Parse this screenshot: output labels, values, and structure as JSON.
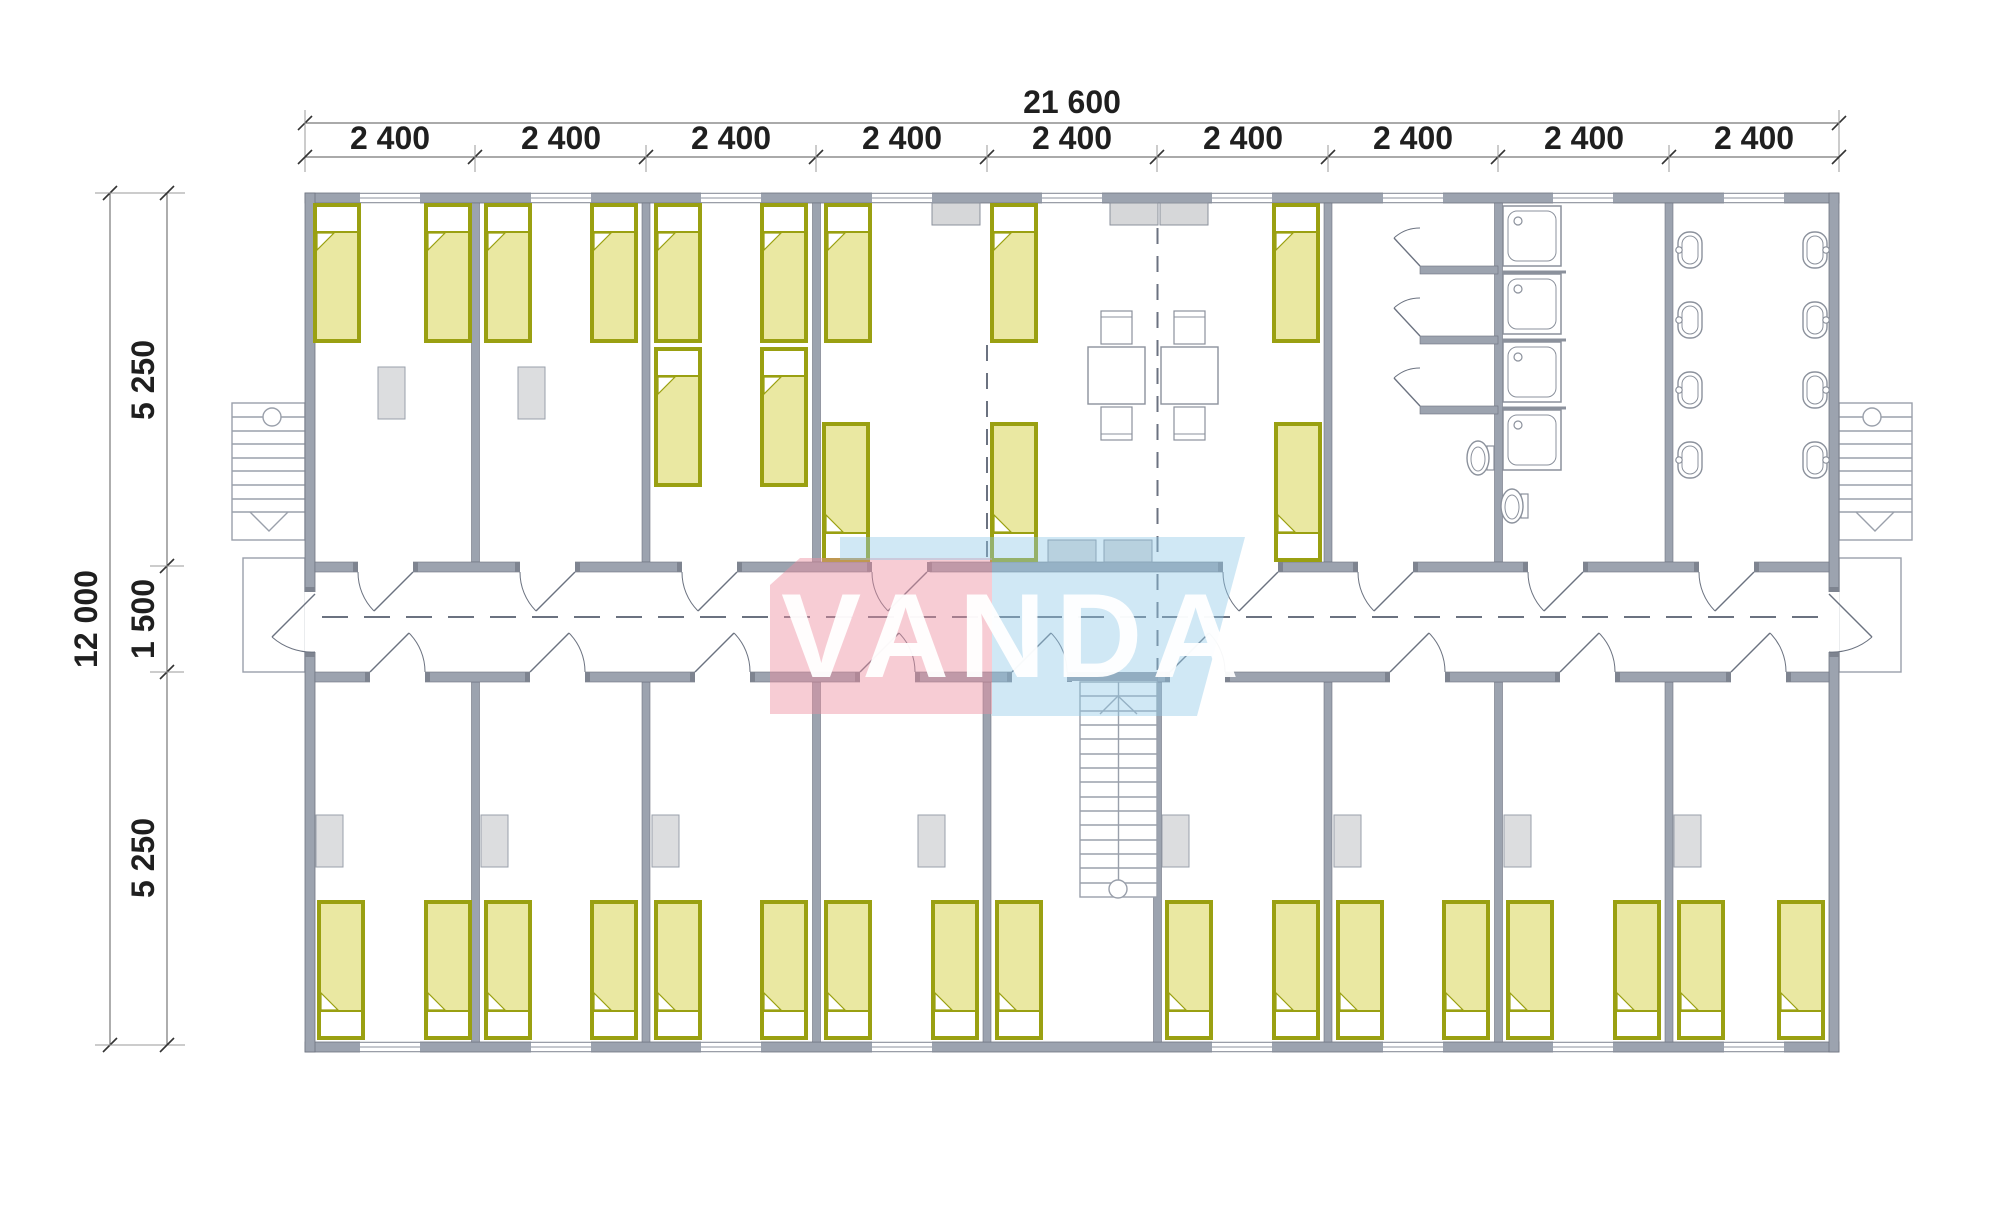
{
  "dimensions": {
    "top_total": "21 600",
    "top_segments": [
      "2 400",
      "2 400",
      "2 400",
      "2 400",
      "2 400",
      "2 400",
      "2 400",
      "2 400",
      "2 400"
    ],
    "left_total": "12 000",
    "left_segments": [
      "5 250",
      "1 500",
      "5 250"
    ]
  },
  "watermark": {
    "text": "VANDA"
  },
  "colors": {
    "bed_fill": "#eae8a2",
    "bed_border": "#9aa011",
    "wall": "#9ca3af",
    "watermark_pink": "#ee8fa0",
    "watermark_blue": "#8ec7e8",
    "dim_text": "#1f1f1f"
  }
}
